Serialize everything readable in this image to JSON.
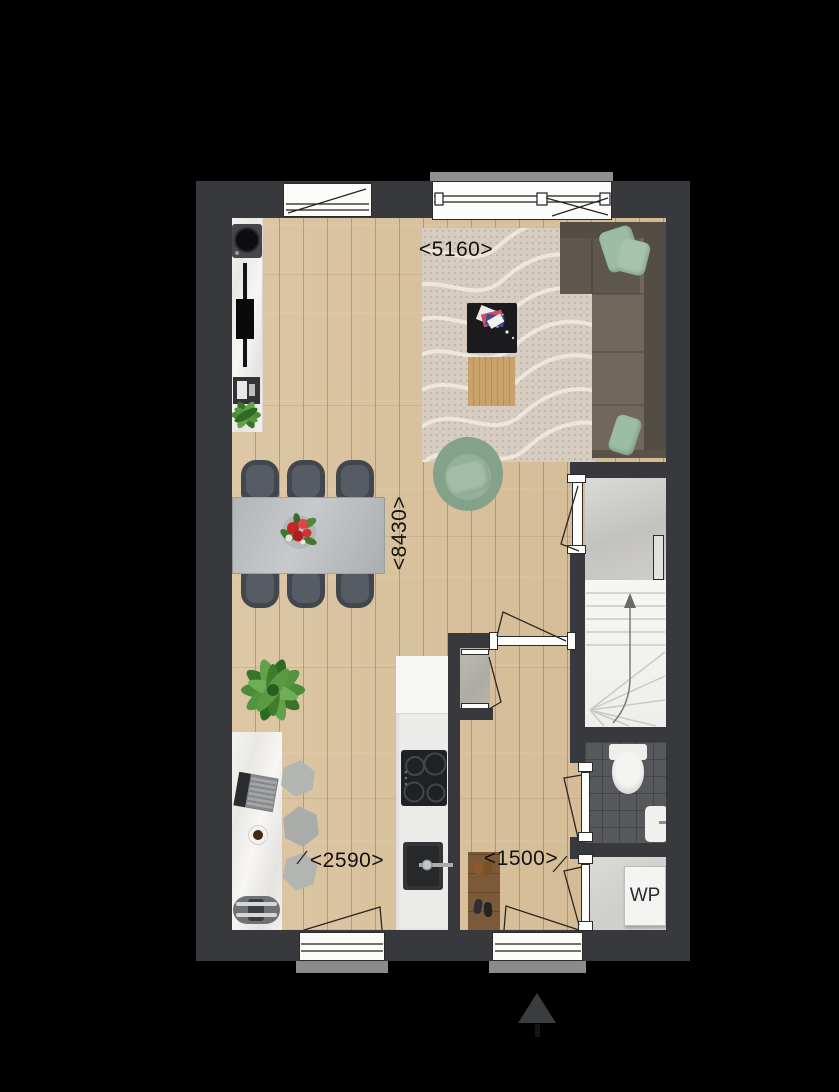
{
  "floorplan": {
    "dimensions": {
      "top_width": "<5160>",
      "left_height": "<8430>",
      "kitchen_width": "<2590>",
      "hallway_width": "<1500>"
    },
    "labels": {
      "heat_pump": "WP"
    },
    "icons": {
      "north": "north-arrow-icon",
      "stairs_direction": "stairs-direction-arrow-icon"
    },
    "colors": {
      "background": "#000000",
      "wall": "#38393c",
      "wood_floor": "#d9c19d",
      "rug": "#d6ccc0",
      "sofa": "#71675d",
      "pillow_green": "#9cbda3",
      "stairs": "#f4f4f3",
      "toilet_tile": "#56585b",
      "concrete": "#cdccca",
      "dining_table": "#bcbfc1",
      "bench_wood": "#7b5a3a"
    }
  }
}
